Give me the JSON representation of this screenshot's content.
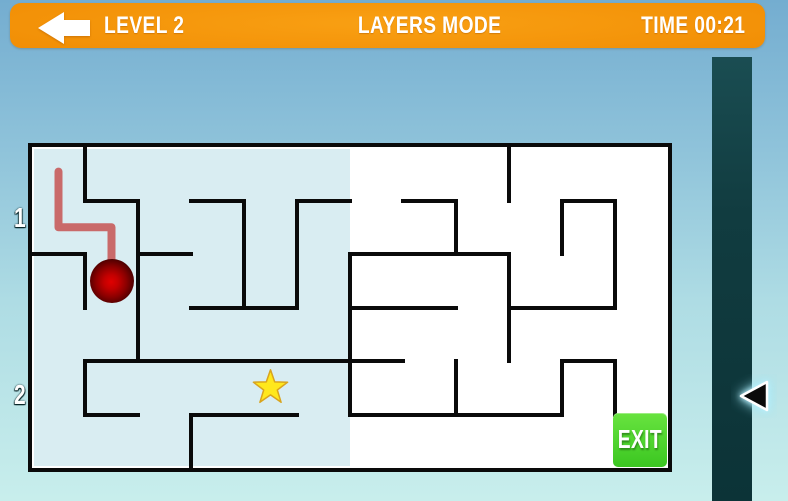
{
  "header": {
    "level": "LEVEL 2",
    "mode": "LAYERS MODE",
    "time": "TIME 00:21"
  },
  "sidebar": {
    "layer1": "1",
    "layer2": "2",
    "active_layer": "2"
  },
  "maze": {
    "grid": {
      "cols": 12,
      "rows": 6,
      "cell_w": 53,
      "cell_h": 53.5,
      "origin_x": 32,
      "origin_y": 147
    },
    "tint": {
      "col_from": 0,
      "col_to": 6,
      "color": "#d9edf2"
    },
    "walls_h": [
      [
        1,
        1,
        2
      ],
      [
        1,
        3,
        4
      ],
      [
        1,
        5,
        6
      ],
      [
        1,
        7,
        8
      ],
      [
        1,
        10,
        11
      ],
      [
        2,
        0,
        1
      ],
      [
        2,
        2,
        3
      ],
      [
        2,
        6,
        9
      ],
      [
        3,
        3,
        5
      ],
      [
        3,
        6,
        8
      ],
      [
        3,
        9,
        11
      ],
      [
        4,
        1,
        7
      ],
      [
        4,
        10,
        11
      ],
      [
        5,
        1,
        2
      ],
      [
        5,
        3,
        5
      ],
      [
        5,
        6,
        10
      ]
    ],
    "walls_v": [
      [
        1,
        0,
        1
      ],
      [
        1,
        2,
        3
      ],
      [
        1,
        4,
        5
      ],
      [
        2,
        1,
        4
      ],
      [
        3,
        5,
        6
      ],
      [
        4,
        1,
        3
      ],
      [
        5,
        1,
        3
      ],
      [
        6,
        2,
        5
      ],
      [
        8,
        1,
        2
      ],
      [
        8,
        4,
        5
      ],
      [
        9,
        0,
        1
      ],
      [
        9,
        2,
        4
      ],
      [
        10,
        1,
        2
      ],
      [
        10,
        4,
        5
      ],
      [
        11,
        1,
        3
      ],
      [
        11,
        4,
        5
      ]
    ],
    "player": {
      "col": 1.5,
      "row": 2.5,
      "radius": 22
    },
    "trail": [
      [
        0.5,
        0.46
      ],
      [
        0.5,
        1.5
      ],
      [
        1.5,
        1.5
      ],
      [
        1.5,
        2.16
      ]
    ],
    "star": {
      "col": 4.5,
      "row": 4.5,
      "outer_r": 18,
      "inner_r": 7.2
    },
    "exit": {
      "label": "EXIT",
      "col": 11,
      "row": 5
    }
  },
  "colors": {
    "header_orange": "#f18d04",
    "sidebar_teal": "#113c40",
    "maze_tint": "#d9edf2",
    "wall_black": "#0a0a0a",
    "trail_pink": "#c96a6a",
    "ball_red": "#c30000",
    "star_yellow": "#ffe81c",
    "star_outline": "#d9a41e",
    "exit_green": "#4fd42f",
    "bg_top": "#74add0",
    "bg_bottom": "#c8eeec"
  }
}
